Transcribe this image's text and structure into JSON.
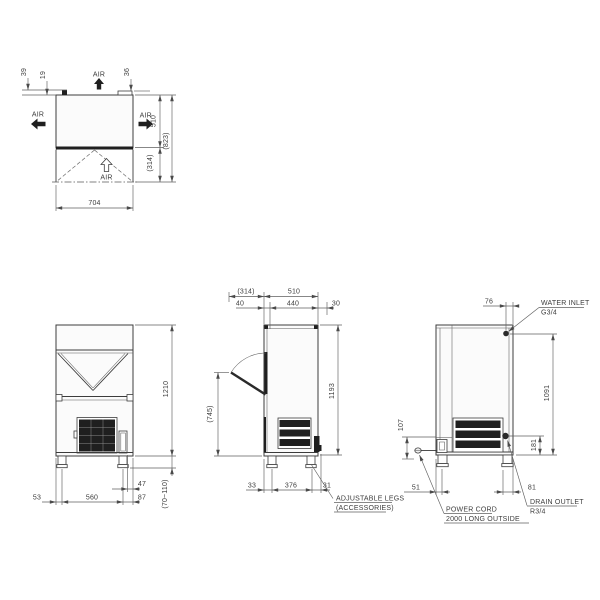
{
  "views": {
    "top": {
      "air_top": "AIR",
      "air_left": "AIR",
      "air_right": "AIR",
      "air_front": "AIR",
      "dim_39": "39",
      "dim_19": "19",
      "dim_36": "36",
      "dim_depth": "510",
      "dim_total_depth": "(823)",
      "dim_door_swing": "(314)",
      "dim_width": "704"
    },
    "front": {
      "dim_height": "1210",
      "dim_53": "53",
      "dim_560": "560",
      "dim_47": "47",
      "dim_87": "87",
      "dim_leg_range": "(70~110)"
    },
    "side": {
      "dim_door_swing": "(314)",
      "dim_depth": "510",
      "dim_40": "40",
      "dim_440": "440",
      "dim_30": "30",
      "dim_door_clear": "(745)",
      "dim_height": "1193",
      "dim_33": "33",
      "dim_376": "376",
      "dim_31": "31",
      "note_legs_1": "ADJUSTABLE LEGS",
      "note_legs_2": "(ACCESSORIES)"
    },
    "rear": {
      "dim_76": "76",
      "dim_height": "1091",
      "dim_107": "107",
      "dim_181": "181",
      "dim_51": "51",
      "dim_81": "81",
      "note_water_1": "WATER INLET",
      "note_water_2": "G3/4",
      "note_drain_1": "DRAIN OUTLET",
      "note_drain_2": "R3/4",
      "note_power_1": "POWER CORD",
      "note_power_2": "2000 LONG OUTSIDE"
    }
  }
}
